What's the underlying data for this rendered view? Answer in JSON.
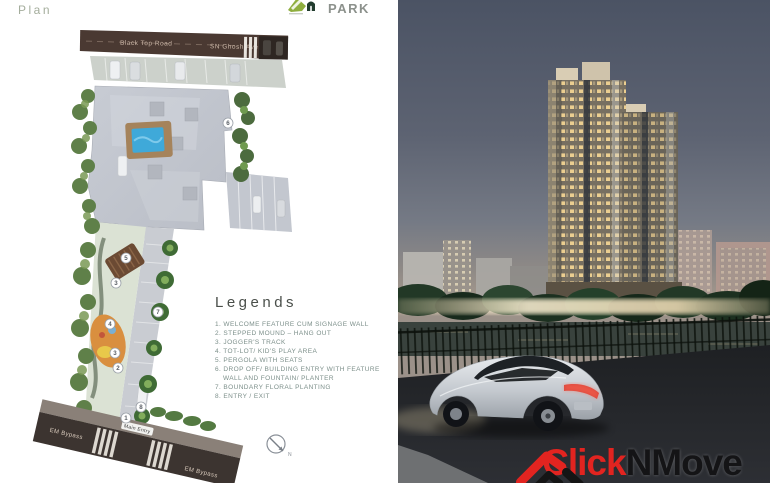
{
  "page": {
    "label": "Plan"
  },
  "brand": {
    "name": "PARK"
  },
  "plan": {
    "top_road_label_1": "Black Top Road",
    "top_road_label_2": "SN Ghosh Ave",
    "main_entry_label": "Main Entry",
    "bottom_road_label_left": "EM Bypass",
    "bottom_road_label_right": "EM Bypass",
    "compass_label": "N",
    "markers": {
      "m1": "1",
      "m2": "2",
      "m3a": "3",
      "m3b": "3",
      "m4": "4",
      "m5": "5",
      "m6": "6",
      "m7": "7",
      "m8": "8"
    }
  },
  "legends": {
    "title": "Legends",
    "items": [
      "1. WELCOME FEATURE CUM SIGNAGE WALL",
      "2. STEPPED MOUND – HANG OUT",
      "3. JOGGER'S TRACK",
      "4. TOT-LOT/ KID'S PLAY AREA",
      "5. PERGOLA WITH SEATS",
      "6. DROP OFF/ BUILDING ENTRY WITH FEATURE WALL AND FOUNTAIN/ PLANTER",
      "7. BOUNDARY FLORAL PLANTING",
      "8. ENTRY / EXIT"
    ]
  },
  "watermark": {
    "part1": "Click",
    "part2": "NMove"
  },
  "colors": {
    "accent_red": "#e22420",
    "plan_road_brown": "#4a3932",
    "pool_blue": "#3fa9d9",
    "legend_teal": "#7c8f8a",
    "sky_top": "#4b5364",
    "window_warm": "#f6d694"
  }
}
